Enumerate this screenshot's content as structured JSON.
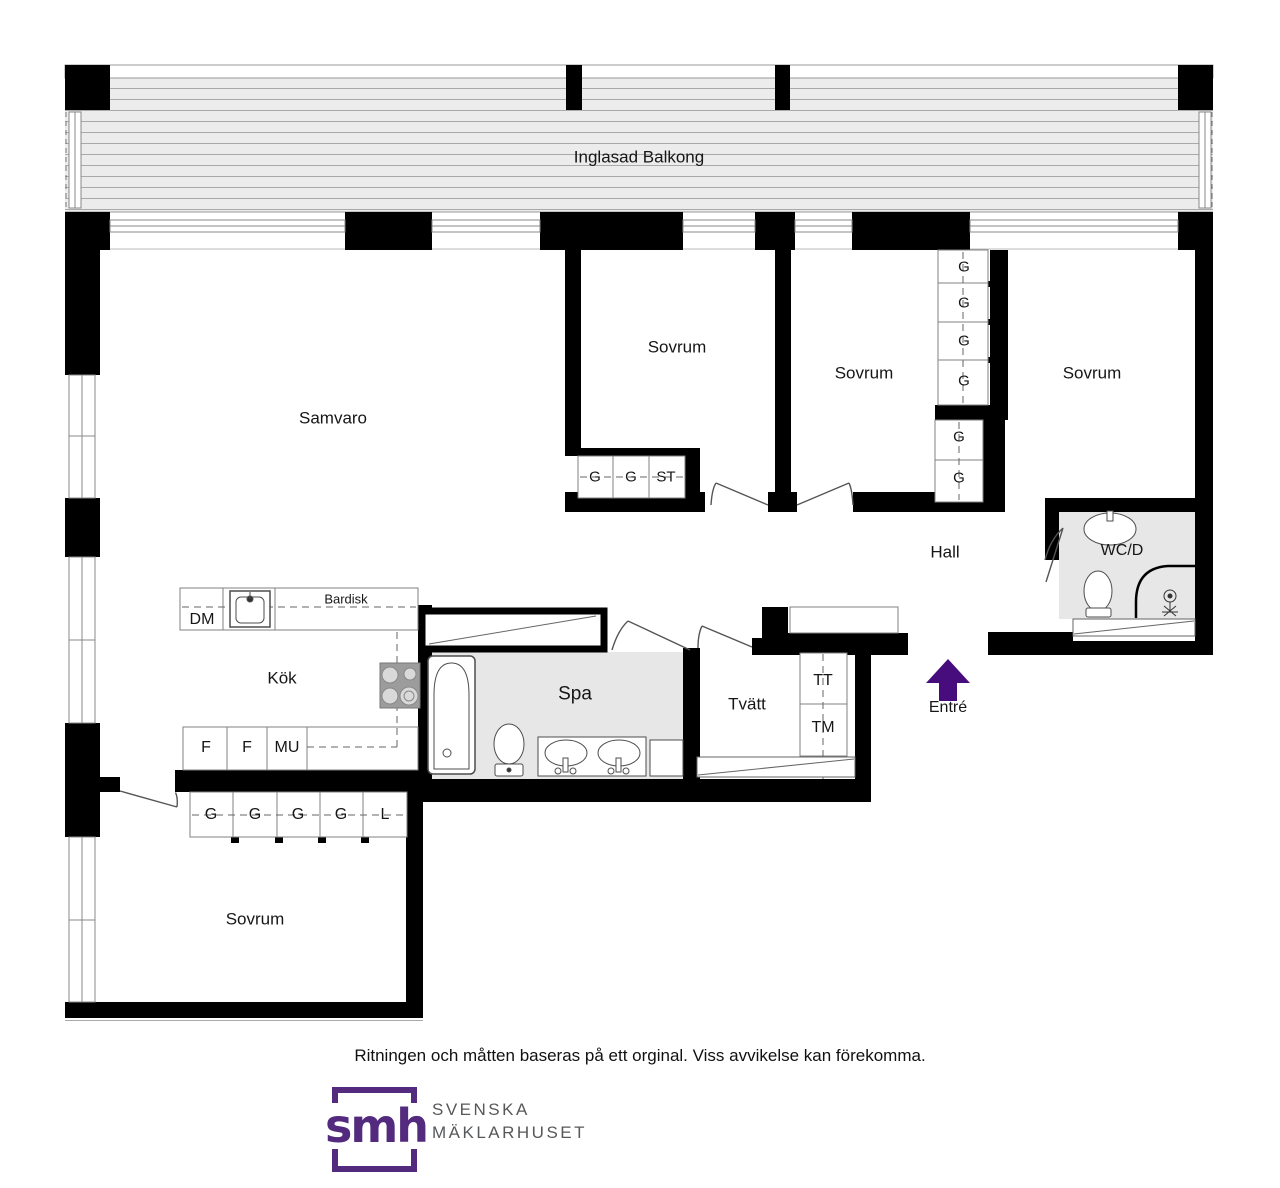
{
  "plan": {
    "balcony": {
      "label": "Inglasad Balkong"
    },
    "rooms": {
      "samvaro": "Samvaro",
      "sovrum_1": "Sovrum",
      "sovrum_2": "Sovrum",
      "sovrum_3": "Sovrum",
      "sovrum_4": "Sovrum",
      "hall": "Hall",
      "wcd": "WC/D",
      "kok": "Kök",
      "spa": "Spa",
      "tvatt": "Tvätt",
      "entre": "Entré"
    },
    "closets": {
      "sov1_row": [
        "G",
        "G",
        "ST"
      ],
      "right_col_upper": [
        "G",
        "G",
        "G",
        "G"
      ],
      "right_col_lower": [
        "G",
        "G"
      ],
      "bottom_row": [
        "G",
        "G",
        "G",
        "G",
        "L"
      ]
    },
    "kitchen": {
      "dm": "DM",
      "bardisk": "Bardisk",
      "f1": "F",
      "f2": "F",
      "mu": "MU"
    },
    "laundry": {
      "tt": "TT",
      "tm": "TM"
    },
    "colors": {
      "wall": "#000000",
      "wet_room_fill": "#e7e7e7",
      "balcony_fill": "#ececec",
      "entry_arrow": "#470d7d",
      "logo_purple": "#532a7d",
      "brand_gray": "#57585a"
    }
  },
  "footer": {
    "disclaimer": "Ritningen och måtten baseras på ett orginal. Viss avvikelse kan förekomma.",
    "logo": {
      "text": "smh",
      "brand_line1": "SVENSKA",
      "brand_line2": "MÄKLARHUSET"
    }
  }
}
